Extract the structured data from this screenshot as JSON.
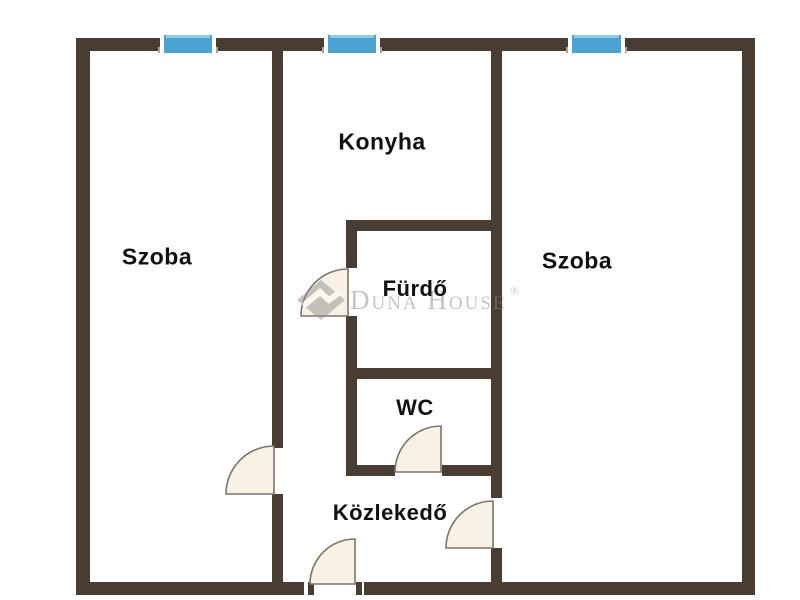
{
  "floorplan": {
    "colors": {
      "background": "#ffffff",
      "wall": "#493d33",
      "window": "#4ba3d1",
      "windowFrame": "#ffffff",
      "doorFill": "#f8f1e5",
      "doorStroke": "#7d756a",
      "label": "#111111",
      "watermark": "#8a8a8a"
    },
    "rooms": [
      {
        "id": "szoba-left",
        "label": "Szoba"
      },
      {
        "id": "konyha",
        "label": "Konyha"
      },
      {
        "id": "szoba-right",
        "label": "Szoba"
      },
      {
        "id": "furdo",
        "label": "Fürdő"
      },
      {
        "id": "wc",
        "label": "WC"
      },
      {
        "id": "kozlekedo",
        "label": "Közlekedő"
      }
    ],
    "watermark": {
      "brand": "Duna House",
      "registered_mark": "®"
    }
  }
}
